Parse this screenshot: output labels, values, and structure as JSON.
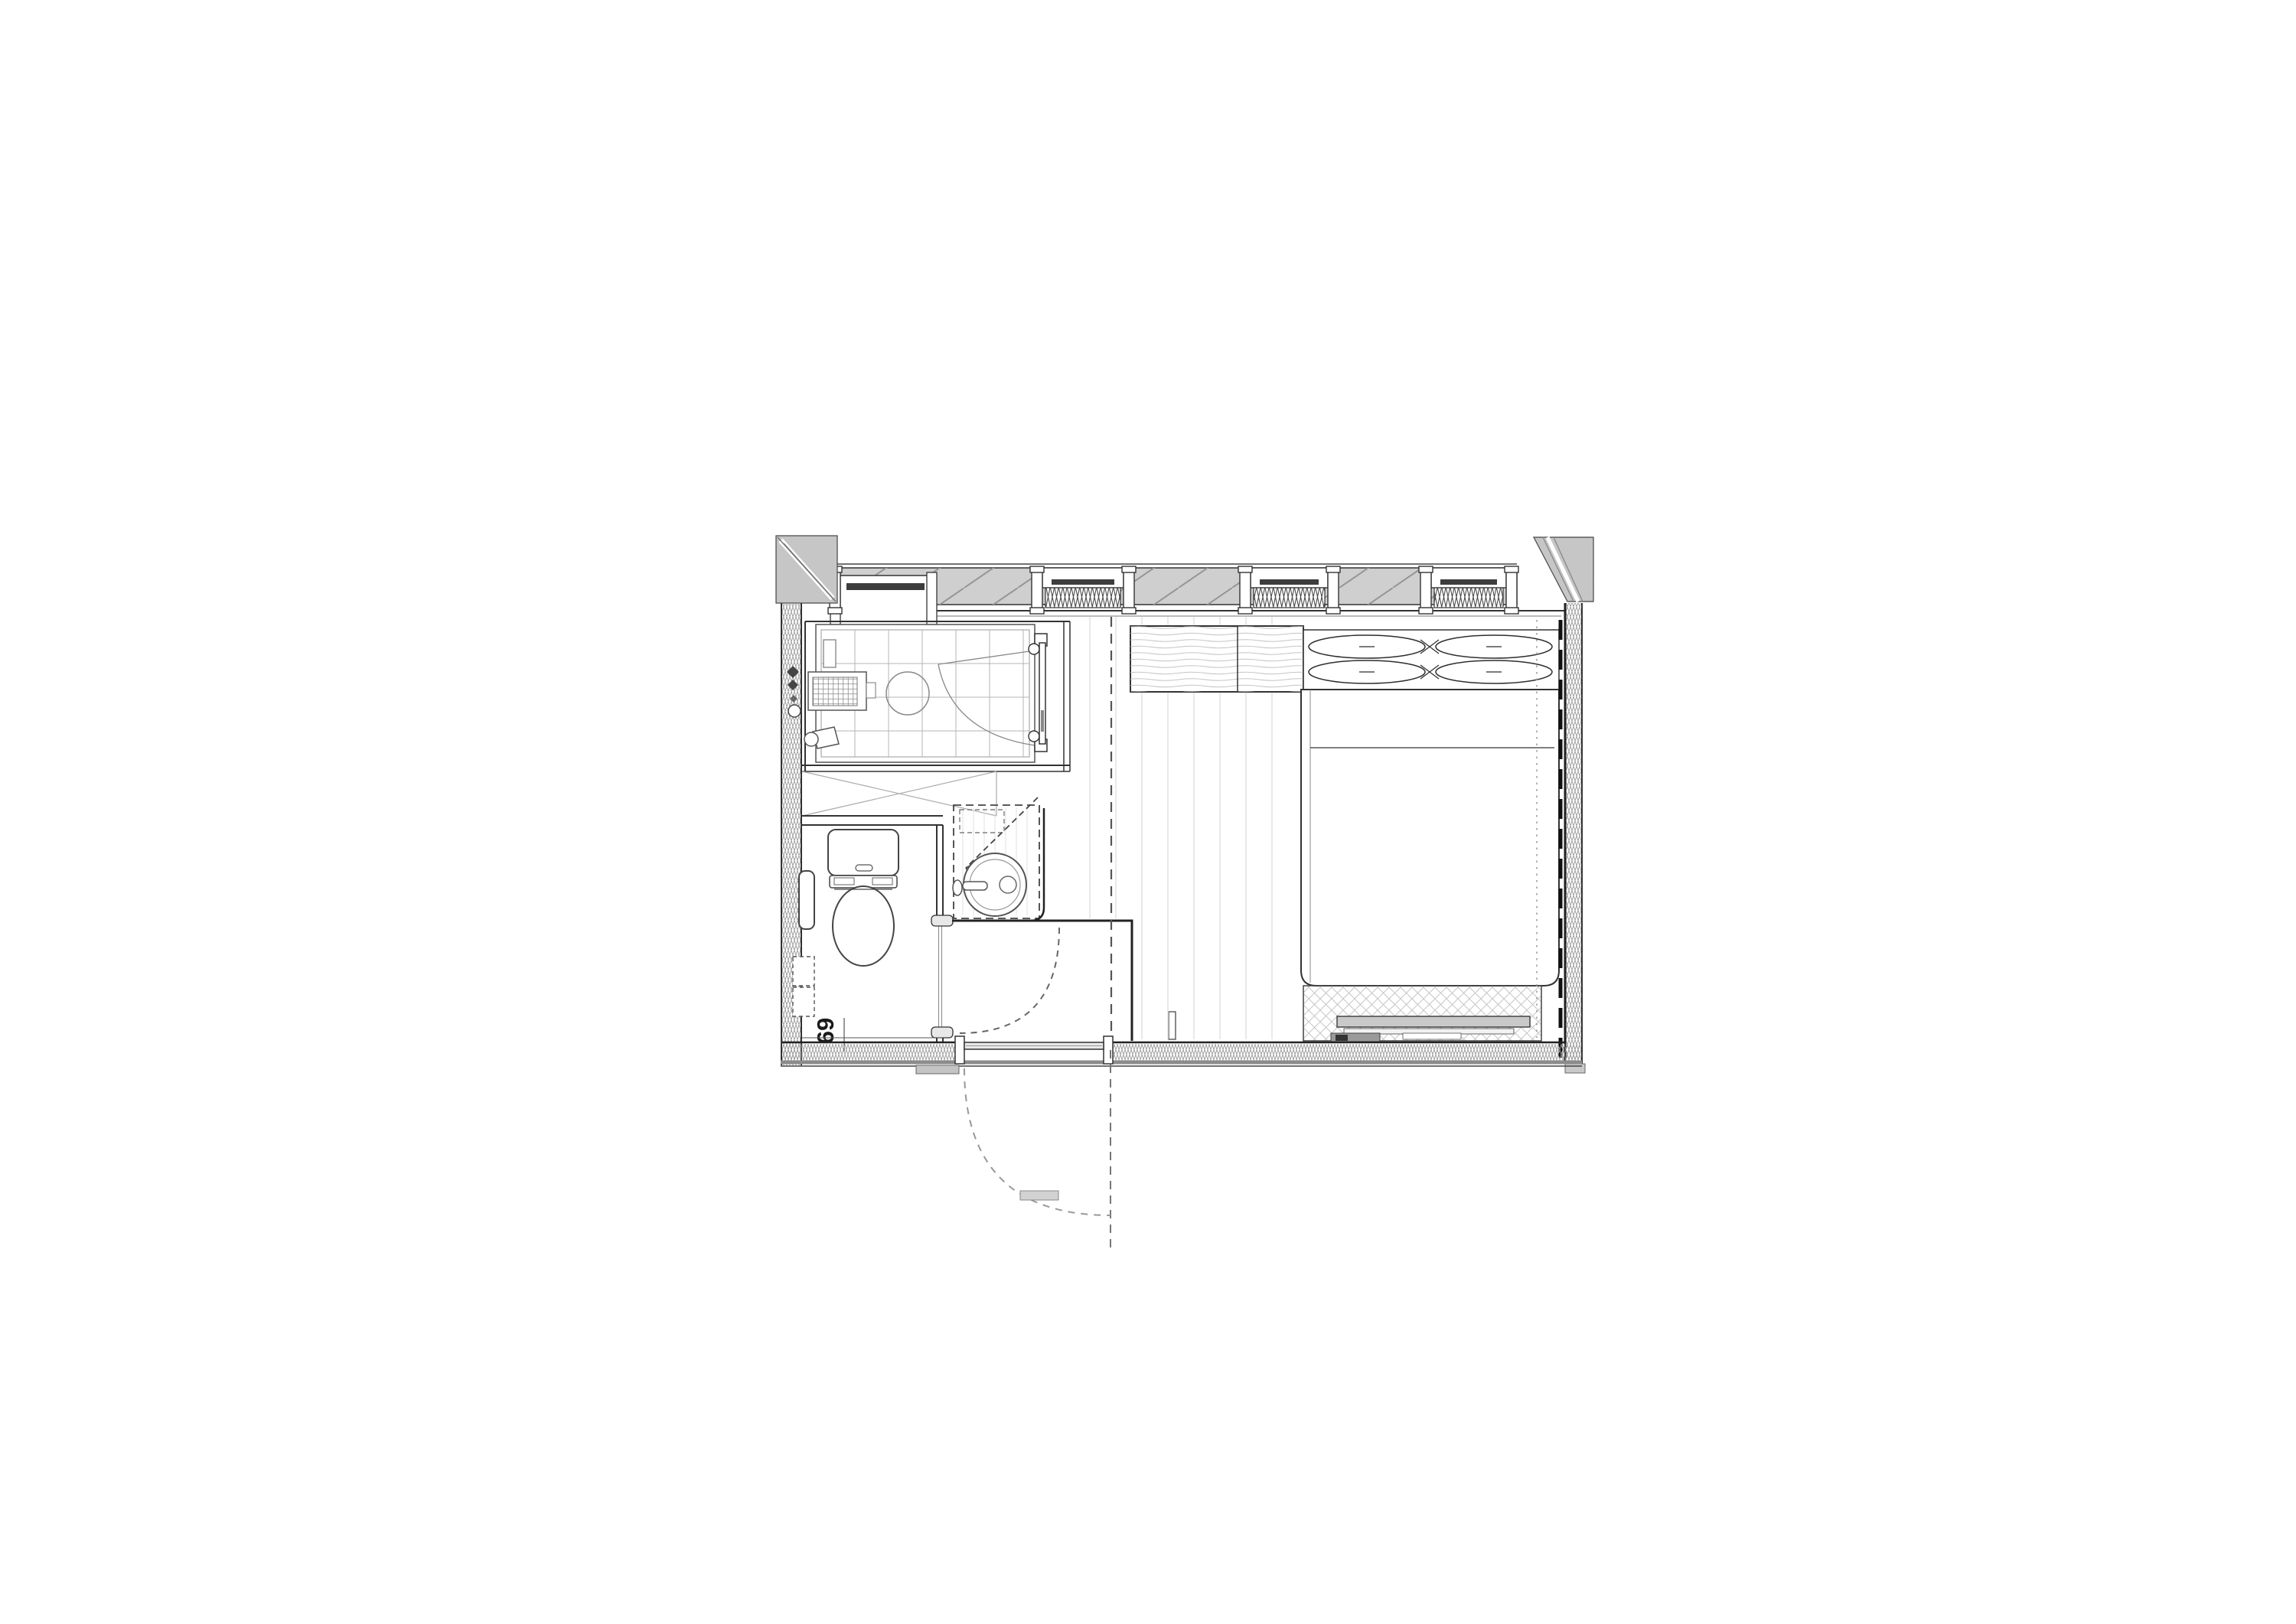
{
  "plan": {
    "title": "hotel-guestroom-floor-plan",
    "room_number": "69",
    "colors": {
      "line": "#333333",
      "heavy_line": "#1a1a1a",
      "glazing_fill": "#cfcfcf",
      "corner_fill": "#c6c6c6",
      "wall_hatch": "#9a9a9a",
      "floor_plank": "#e2e2e2",
      "tile_grid": "#b5b5b5",
      "bench_fill": "#c9c9c9",
      "paper": "#ffffff"
    },
    "legend": [
      "window wall with roller blinds and pleated curtains",
      "corner columns with diagonal section hatch",
      "shower room with tiled floor, drain grate, stool and hinged glass door",
      "toilet room with washlet, wall control panel and paper holder",
      "washbasin counter (dashed = overhead cabinet) with round basin",
      "entry hall, outward swinging entrance door with dashed swing arc",
      "toilet door swing arc into hall",
      "double bed with two pillows and wood headboard counter",
      "luggage bench on cross-hatched mat at bed foot",
      "insulated party walls (zigzag hatch)"
    ]
  }
}
